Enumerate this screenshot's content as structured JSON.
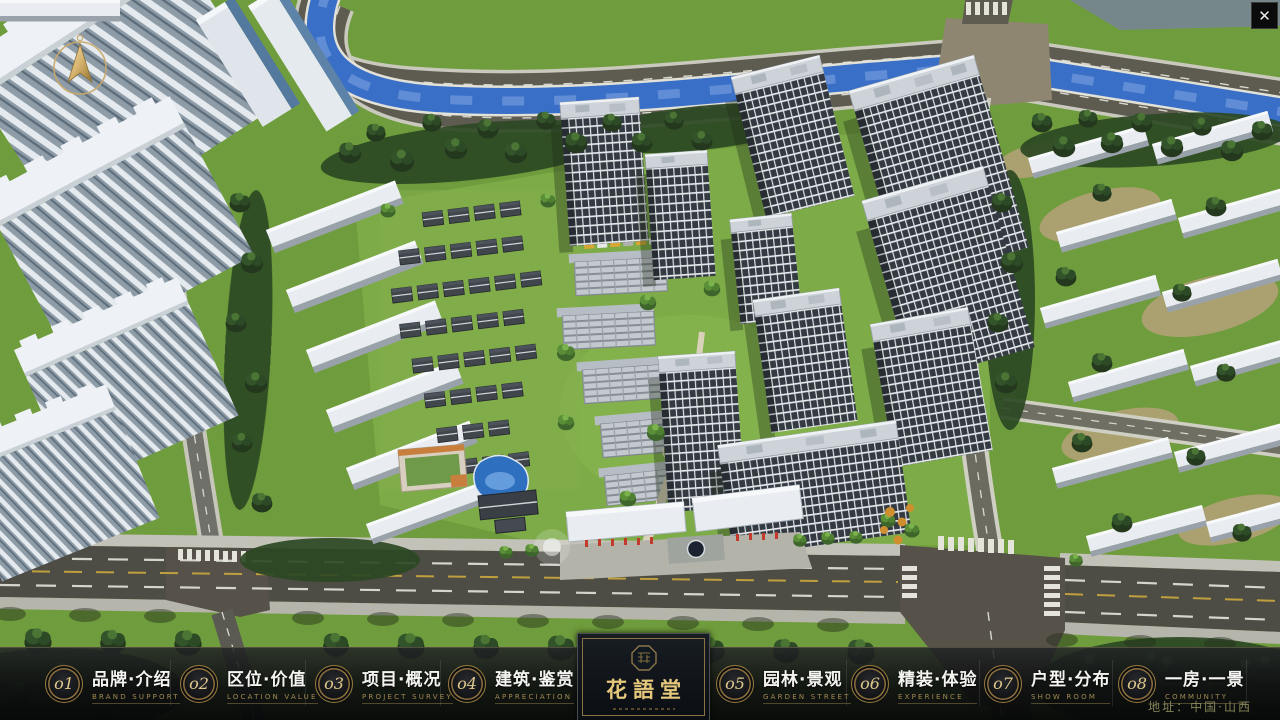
{
  "window": {
    "close_glyph": "✕"
  },
  "nav": {
    "items": [
      {
        "num": "o1",
        "zh": "品牌·介绍",
        "en": "BRAND SUPPORT"
      },
      {
        "num": "o2",
        "zh": "区位·价值",
        "en": "LOCATION VALUE"
      },
      {
        "num": "o3",
        "zh": "项目·概况",
        "en": "PROJECT SURVEY"
      },
      {
        "num": "o4",
        "zh": "建筑·鉴赏",
        "en": "APPRECIATION"
      },
      {
        "num": "o5",
        "zh": "园林·景观",
        "en": "GARDEN STREET"
      },
      {
        "num": "o6",
        "zh": "精装·体验",
        "en": "EXPERIENCE"
      },
      {
        "num": "o7",
        "zh": "户型·分布",
        "en": "SHOW ROOM"
      },
      {
        "num": "o8",
        "zh": "一房·一景",
        "en": "COMMUNITY"
      }
    ]
  },
  "logo": {
    "title": "花語堂"
  },
  "footer": {
    "address": "地址：中国·山西"
  },
  "theme": {
    "gold": "#c9a86a",
    "bar_background": "#15171a",
    "river_blue": "#3a6fc8",
    "grass_green": "#6f9c3c"
  }
}
